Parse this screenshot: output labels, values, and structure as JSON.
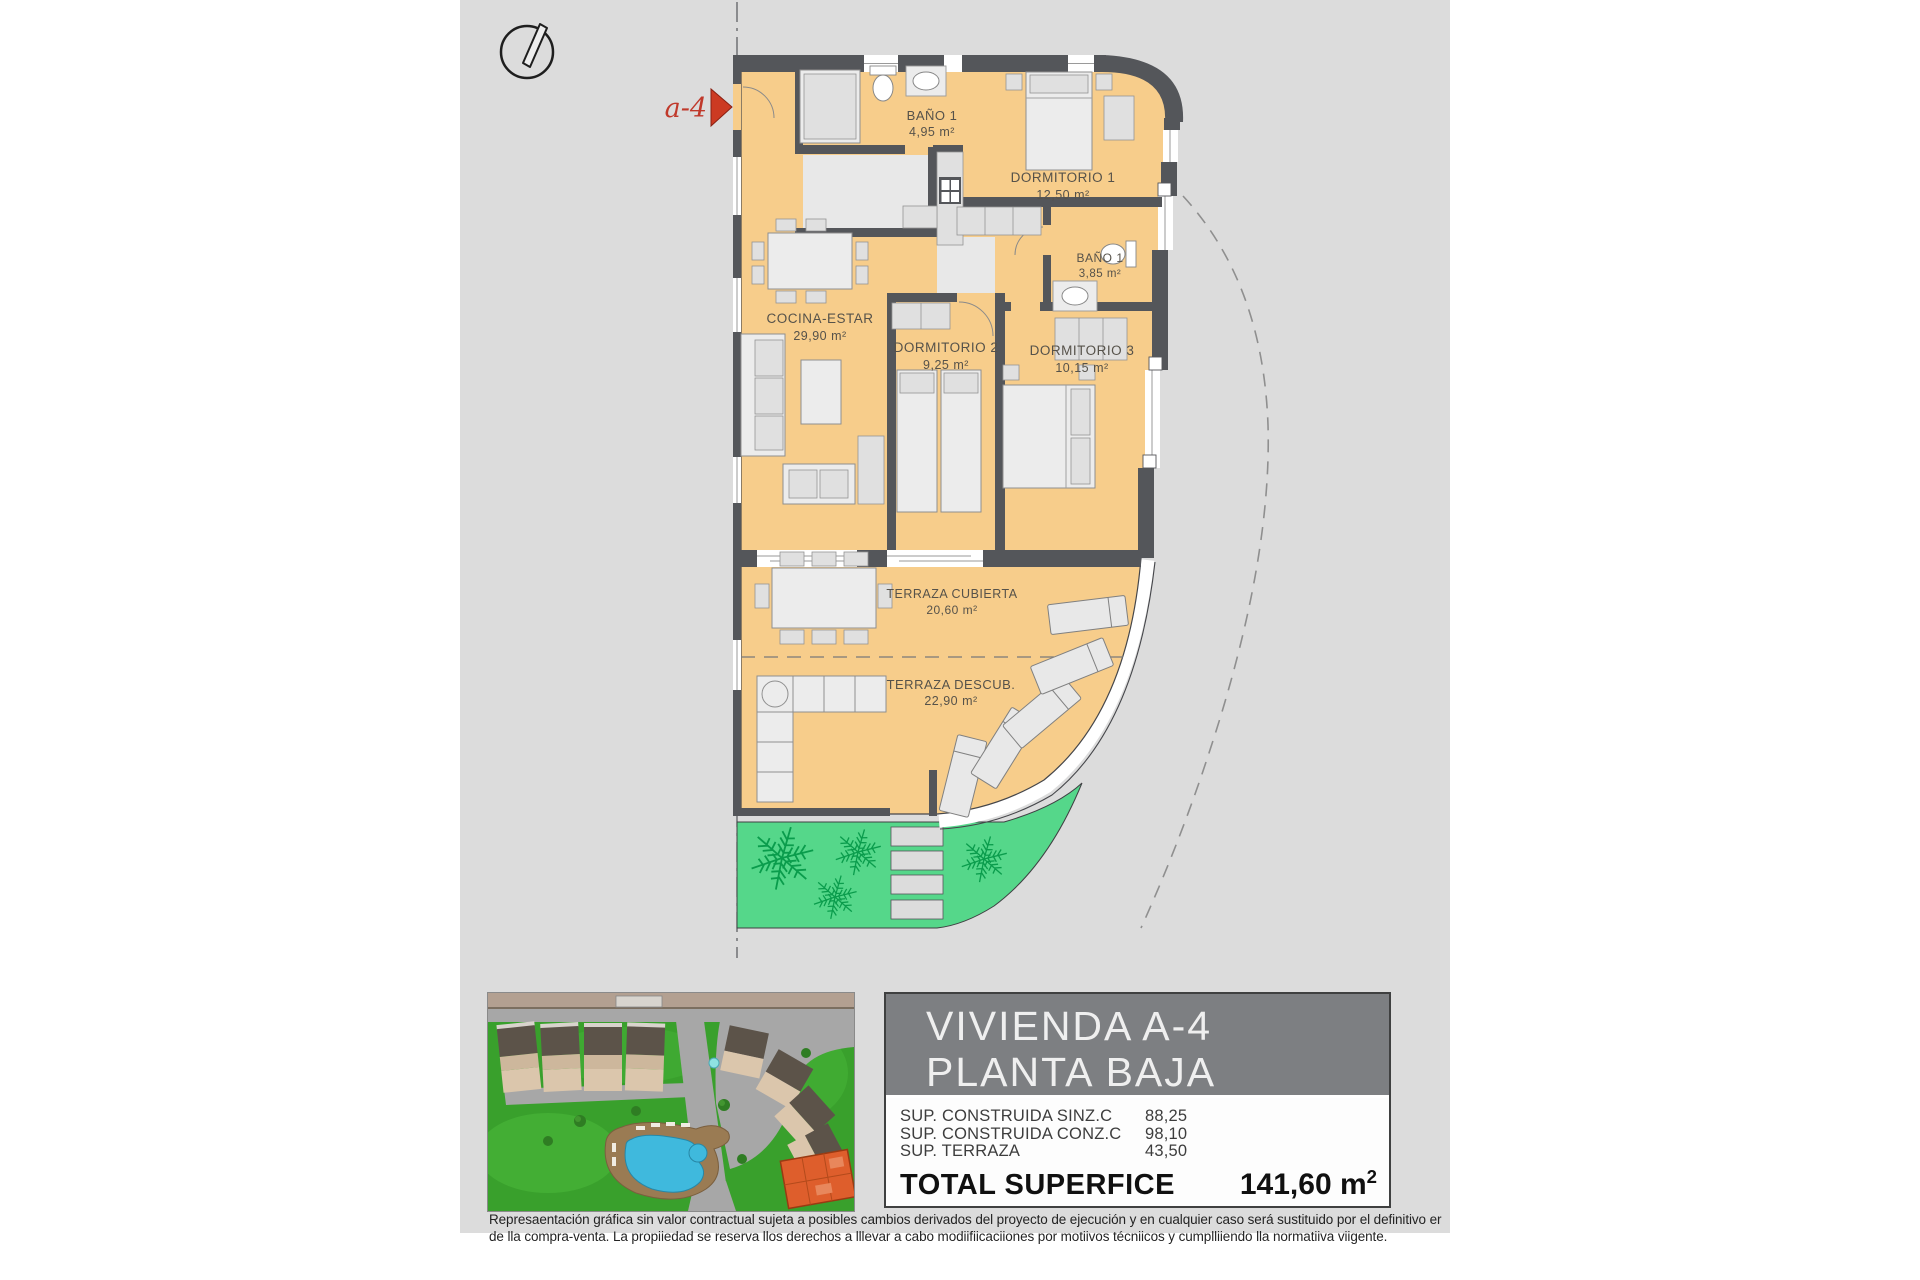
{
  "plan": {
    "section_marker": "a-4",
    "rooms": {
      "bano1_top": {
        "name": "BAÑO 1",
        "area": "4,95 m²"
      },
      "dormitorio1": {
        "name": "DORMITORIO 1",
        "area": "12,50 m²"
      },
      "bano1_inner": {
        "name": "BAÑO 1",
        "area": "3,85 m²"
      },
      "cocina_estar": {
        "name": "COCINA-ESTAR",
        "area": "29,90 m²"
      },
      "dormitorio2": {
        "name": "DORMITORIO 2",
        "area": "9,25 m²"
      },
      "dormitorio3": {
        "name": "DORMITORIO 3",
        "area": "10,15 m²"
      },
      "terraza_cubierta": {
        "name": "TERRAZA CUBIERTA",
        "area": "20,60 m²"
      },
      "terraza_descubierta": {
        "name": "TERRAZA DESCUB.",
        "area": "22,90 m²"
      }
    }
  },
  "info_panel": {
    "title_line1": "VIVIENDA A-4",
    "title_line2": "PLANTA BAJA",
    "rows": [
      {
        "label": "SUP. CONSTRUIDA SINZ.C",
        "value": "88,25"
      },
      {
        "label": "SUP. CONSTRUIDA CONZ.C",
        "value": "98,10"
      },
      {
        "label": "SUP. TERRAZA",
        "value": "43,50"
      }
    ],
    "total_label": "TOTAL SUPERFICE",
    "total_value": "141,60 m",
    "total_sup": "2"
  },
  "disclaimer": {
    "line1": "Represaentación gráfica sin valor contractual sujeta a posibles cambios derivados del proyecto de ejecución y en cualquier caso será sustituido por el definitivo er",
    "line2": "de lla compra-venta. La propiiedad se reserva llos derechos a lllevar a cabo modiifiicaciiones por motiivos técniicos y cumplliiendo lla normatiiva viigente."
  },
  "colors": {
    "floor": "#F7CD8B",
    "wall": "#54565A",
    "garden_green": "#55D78A",
    "plant_green": "#0A9C4C",
    "page_gray": "#DCDCDC",
    "accent_red": "#C93A22",
    "header_gray": "#7D7F82",
    "highlight_unit_orange": "#DE5E2C"
  }
}
